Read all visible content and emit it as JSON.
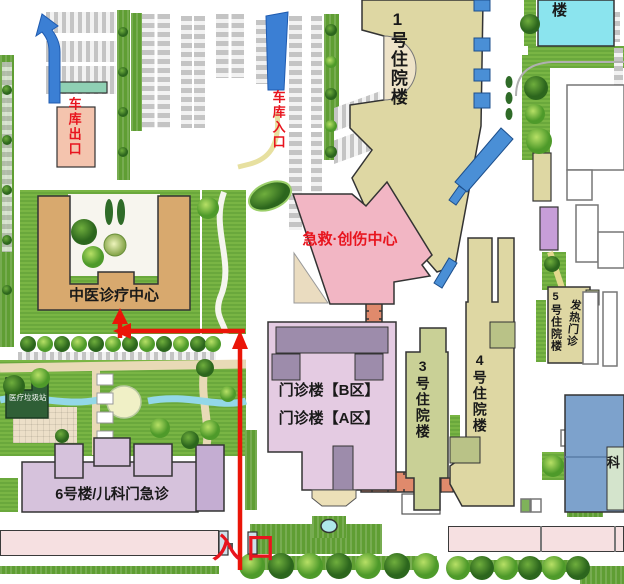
{
  "map_title": "hospital-campus-map",
  "buildings": {
    "inpatient_1": "1号住院楼",
    "emergency_trauma": "急救·创伤中心",
    "tcm_center": "中医诊疗中心",
    "outpatient_b": "门诊楼【B区】",
    "outpatient_a": "门诊楼【A区】",
    "inpatient_3": "3号住院楼",
    "inpatient_4": "4号住院楼",
    "inpatient_5": "5号住院楼",
    "fever_clinic": "发热门诊",
    "building_6": "6号楼/儿科门急诊",
    "medical_waste_station": "医疗垃圾站",
    "northeast_tower_partial": "楼",
    "east_dept_partial": "科"
  },
  "annotations": {
    "garage_exit": "车库出口",
    "garage_entrance": "车库入口",
    "main_entrance": "入口"
  },
  "colors": {
    "route_red": "#e8141e",
    "building_tan": "#ded7a3",
    "building_ochre": "#d8a96e",
    "building_pink": "#f2b6c4",
    "building_lavender": "#e4cbe2",
    "building_purple_dark": "#9d8cab",
    "building_sage": "#c9d096",
    "building_cyan": "#8be4ee",
    "building_blue": "#7da2cc",
    "corridor_salmon": "#e08a6c",
    "canopy_blue": "#4a8fd6",
    "lawn_green": "#79b544",
    "wall_pink": "#f6e0e1"
  }
}
